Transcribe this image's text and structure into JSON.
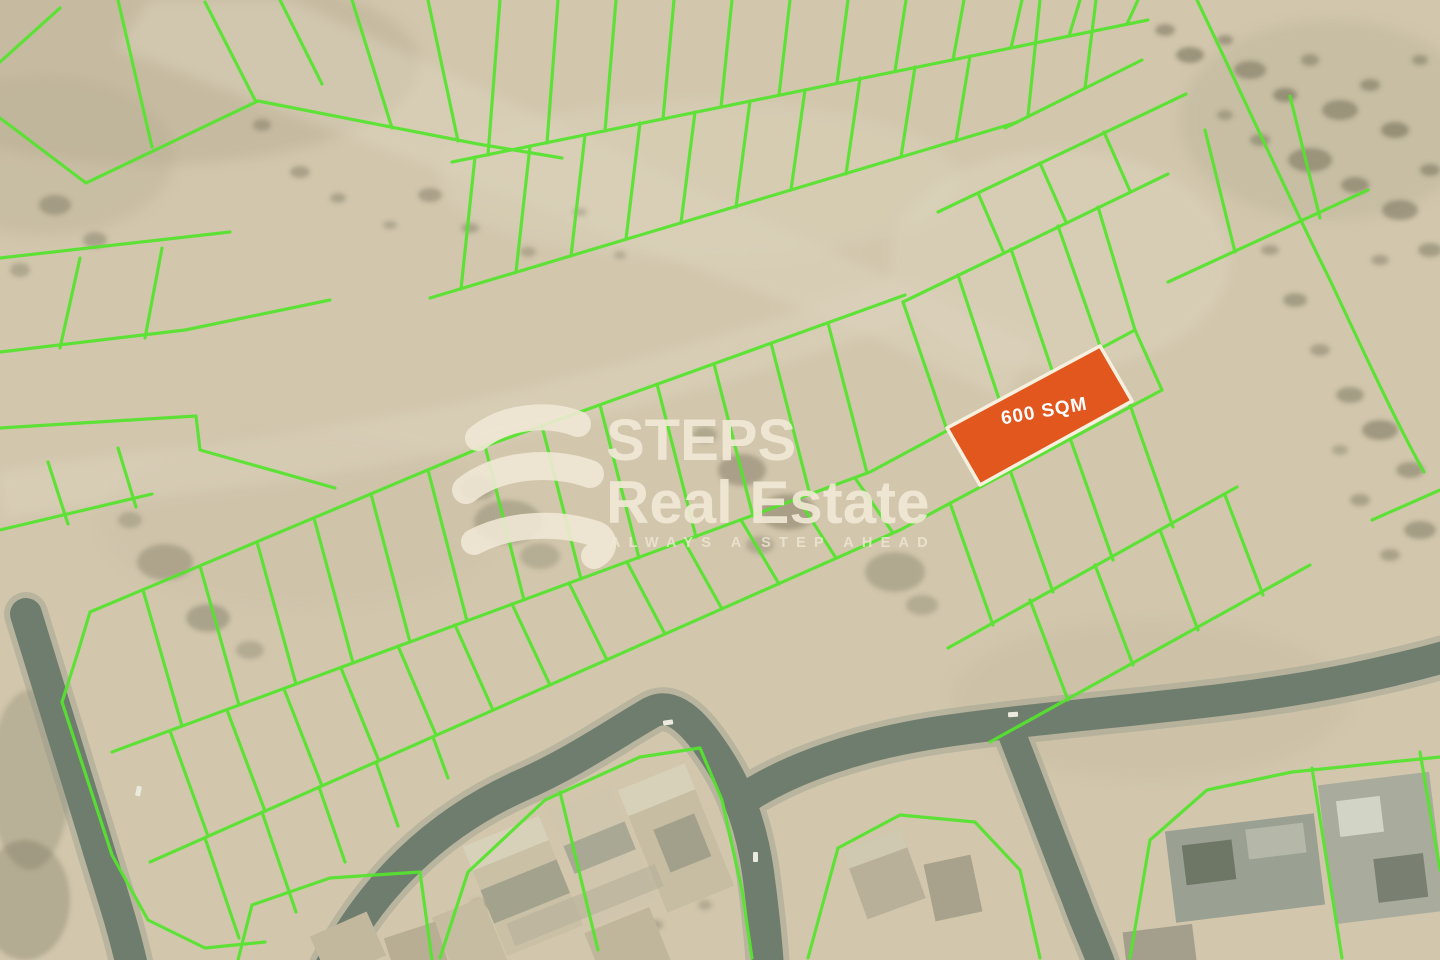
{
  "map": {
    "highlighted_plot": {
      "label": "600 SQM",
      "fill": "#e2571e",
      "border": "#f7f0de"
    },
    "boundary_color": "#55e42e",
    "terrain_color": "#d2c7ad",
    "road_color": "#6f7d6e"
  },
  "watermark": {
    "brand_line1": "STEPS",
    "brand_line2": "Real Estate",
    "tagline": "ALWAYS A STEP AHEAD",
    "color": "#f1e9d6"
  }
}
